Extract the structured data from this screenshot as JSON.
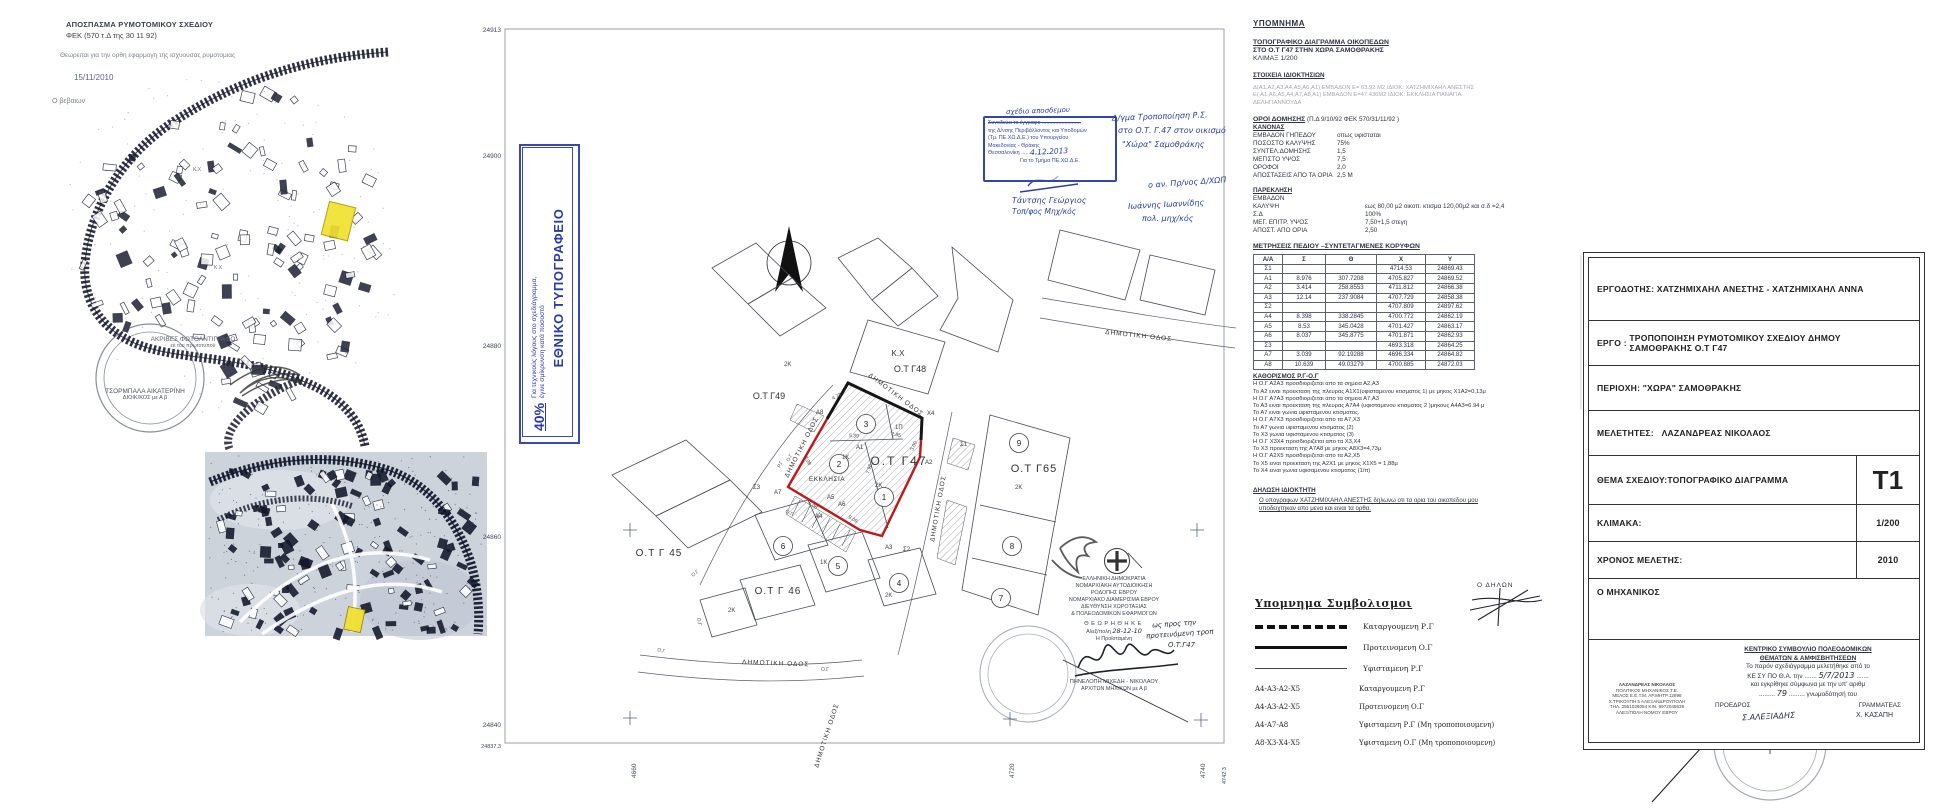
{
  "colors": {
    "highlight_yellow": "#f0e130",
    "boundary_red": "#c01818",
    "ink_blue": "#2b3f9e",
    "stamp_blue": "#3347a8"
  },
  "extract": {
    "title": "ΑΠΟΣΠΑΣΜΑ ΡΥΜΟΤΟΜΙΚΟΥ ΣΧΕΔΙΟΥ",
    "fek": "ΦΕΚ  (570 τ.Δ  της 30 11 92)",
    "certify": "Θεωρειται για την ορθη εφαρμογη της ισχυουσας ρυμοτομιας",
    "date": "15/11/2010",
    "certifier": "Ο βεβαιων",
    "copy_stamp": {
      "l1": "ΑΚΡΙΒΕΣ ΦΩΤΟΑΝΤΙΓΡΑΦΟ",
      "l2": "εκ του πρωτοτυπου",
      "name": "ΤΣΟΡΜΠΑΛΑ ΑΙΚΑΤΕΡΙΝΗ",
      "role": "ΔΙΟΙΚ/ΚΟΣ με Α β"
    }
  },
  "print_box": {
    "title": "ΕΘΝΙΚΟ ΤΥΠΟΓΡΑΦΕΙΟ",
    "note1": "Για τεχνικούς λόγους στο σχεδιάγραμμα,",
    "note2": "έγινε σμίκρυνση κατά ποσοστό",
    "percent": "40%"
  },
  "blue_stamp": {
    "l1": "Συνοδεύει το έγγραφο ..........................",
    "hand1": "σχέδιο αποσδεμου",
    "l2": "της Δ/νσης Περιβάλλοντος και Υποδομών",
    "l3": "(Τμ. ΠΕ.ΧΩ.Δ.Ε.)  του  Υπουργείου",
    "l4": "Μακεδονίας - Θράκης",
    "l5": "Θεσσαλονίκη ......................",
    "hand_date": "4.12.2013",
    "l6": "Για  το  Τμήμα  ΠΕ.ΧΩ.Δ.Ε.",
    "sig_name": "Τάντσης Γεώργιος",
    "sig_role": "Τοπ/φος Μηχ/κός"
  },
  "annotations": {
    "r1": "Δ/γμα Τροποποίηση Ρ.Σ.",
    "r2": "στο Ο.Τ. Γ.47 στον οικισμό",
    "r3": "\"Χώρα\" Σαμοθράκης",
    "r4": "ο αν. Πρ/νος Δ/ΧΩΠ",
    "r5": "Ιωάννης Ιωαννίδης",
    "r6": "πολ. μηχ/κός"
  },
  "drawing": {
    "street": "ΔΗΜΟΤΙΚΗ ΟΔΟΣ",
    "axis_left": [
      "24913",
      "24900",
      "24880",
      "24860",
      "24840",
      "24837.3"
    ],
    "axis_bottom": [
      "4660",
      "4720",
      "4740",
      "4742.3"
    ],
    "blocks": {
      "g47": "Ο.Τ Γ47",
      "g48": "Ο.Τ Γ48",
      "g49": "Ο.Τ Γ49",
      "g65": "Ο.Τ Γ65",
      "g45": "Ο.Τ Γ 45",
      "g46": "Ο.Τ Γ 46",
      "kx": "Κ.Χ"
    },
    "church": "ΕΚΚΛΗΣΙΑ",
    "plots": [
      "1",
      "2",
      "3",
      "4",
      "5",
      "6",
      "7",
      "8",
      "9"
    ],
    "vertices": {
      "s1": "Σ1",
      "s2": "Σ2",
      "s3": "Σ3",
      "a1": "Α1",
      "a2": "Α2",
      "a3": "Α3",
      "a4": "Α4",
      "a5": "Α5",
      "a6": "Α6",
      "a7": "Α7",
      "a8": "Α8",
      "x4": "Χ4"
    },
    "storeys": {
      "k2": "2Κ",
      "k1": "1Κ",
      "p1": "1Π"
    },
    "rg": "Ρ.Γ",
    "og": "Ο.Γ",
    "dims": [
      "4.73",
      "5.39",
      "2.85",
      "3.00",
      "7.98",
      "8.98",
      "9.09",
      "5.08"
    ]
  },
  "approval_stamp": {
    "l1": "ΕΛΛΗΝΙΚΗ ΔΗΜΟΚΡΑΤΙΑ",
    "l2": "ΝΟΜΑΡΧΙΑΚΗ ΑΥΤΟΔΙΟΙΚΗΣΗ",
    "l3": "ΡΟΔΟΠΗΣ ΕΒΡΟΥ",
    "l4": "ΝΟΜΑΡΧΙΑΚΟ ΔΙΑΜΕΡΙΣΜΑ ΕΒΡΟΥ",
    "l5": "ΔΙΕΥΘΥΝΣΗ ΧΩΡΟΤΑΞΙΑΣ",
    "l6": "& ΠΟΛΕΟΔΟΜΙΚΩΝ ΕΦΑΡΜΟΓΩΝ",
    "approved": "ΘΕΩΡΗΘΗΚΕ",
    "place": "Αλεξ/πολη",
    "hand_date": "28-12-10",
    "head": "Η  Προϊσταμένη",
    "hand_note1": "ως προς την",
    "hand_note2": "προτεινόμενη τροπ",
    "hand_note3": "Ο.Τ.Γ47",
    "name": "ΠΗΝΕΛΟΠΗ ΜΙΧΕΔΗ - ΝΙΚΟΛΑΟΥ",
    "role": "ΑΡΧ/ΤΩΝ ΜΗΧ/ΚΩΝ με Α β"
  },
  "legend": {
    "title": "ΥΠΟΜΝΗΜΑ",
    "sub1": "ΤΟΠΟΓΡΑΦΙΚΟ  ΔΙΑΓΡΑΜΜΑ ΟΙΚΟΠΕΔΩΝ",
    "sub2": "ΣΤΟ  Ο.Τ Γ47 ΣΤΗΝ ΧΩΡΑ ΣΑΜΟΘΡΑΚΗΣ",
    "sub3": "ΚΛΙΜΑΞ  1/200",
    "own_title": "ΣΤΟΙΧΕΙΑ ΙΔΙΟΚΤΗΣΙΩΝ",
    "own1": "Δ(Α1,Α2,Α3,Α4,Α5,Α6,Α1) ΕΜΒΑΔΟΝ  Ε= 63.92 Μ2   ΙΔΙΟΚ:  ΧΑΤΖΗΜΙΧΑΗΛ ΑΝΕΣΤΗΣ",
    "own2": "Ε( Α1,Α6,Α5,Α4,Α7,Α8,Α1) ΕΜΒΑΔΟΝ Ε=47.436Μ2  ΙΔΙΟΚ:  ΕΚΚΛΗΣΙΑ ΠΑΝΑΓΙΑ",
    "own3": "ΔΕΛΗΓΙΑΝΝΟΥΔΑ",
    "terms_title": "ΟΡΟΙ   ΔΟΜΗΣΗΣ",
    "terms_ref": "(Π.Δ 9/10/92 ΦΕΚ 570/31/11/92 )",
    "kanonas": "ΚΑΝΟΝΑΣ",
    "kanonas_rows": [
      [
        "ΕΜΒΑΔΟΝ ΓΗΠΕΔΟΥ",
        "οπως υφισταται"
      ],
      [
        "ΠΟΣΟΣΤΟ ΚΑΛΥΨΗΣ",
        "75%"
      ],
      [
        "ΣΥΝΤΕΛ.ΔΟΜΗΣΗΣ",
        "1,5"
      ],
      [
        "ΜΕΓΙΣΤΟ ΥΨΟΣ",
        "7,5"
      ],
      [
        "ΟΡΟΦΟΙ",
        "2,0"
      ],
      [
        "ΑΠΟΣΤΑΣΕΙΣ ΑΠΟ ΤΑ ΟΡΙΑ",
        "2,5 Μ"
      ]
    ],
    "parekl": "ΠΑΡΕΚΛΗΣΗ",
    "parekl_rows": [
      [
        "ΕΜΒΑΔΟΝ",
        ""
      ],
      [
        "ΚΑΛΥΨΗ",
        "εως 80,00 μ2 οικοπ. κτισμα 120,00μ2 και σ.δ =2,4"
      ],
      [
        "Σ.Δ",
        "100%"
      ],
      [
        "ΜΕΓ. ΕΠΙΤΡ. ΥΨΟΣ",
        "7,50+1,5 στεγη"
      ],
      [
        "ΑΠΟΣΤ. ΑΠΟ ΟΡΙΑ",
        "2,50"
      ]
    ],
    "table_title": "ΜΕΤΡΗΣΕΙΣ ΠΕΔΙΟΥ –ΣΥΝΤΕΤΑΓΜΕΝΕΣ ΚΟΡΥΦΩΝ",
    "table_head": [
      "Α/Α",
      "Σ",
      "Θ",
      "Χ",
      "Υ"
    ],
    "table_rows": [
      [
        "Σ1",
        "",
        "",
        "4714.53",
        "24869.43"
      ],
      [
        "Α1",
        "8.976",
        "307.7208",
        "4705.827",
        "24869.52"
      ],
      [
        "Α2",
        "3.414",
        "258.8553",
        "4711.812",
        "24866.38"
      ],
      [
        "Α3",
        "12.14",
        "237.9084",
        "4707.729",
        "24858.38"
      ],
      [
        "Σ2",
        "",
        "",
        "4707.809",
        "24897.62"
      ],
      [
        "Α4",
        "8.398",
        "338.2845",
        "4700.772",
        "24862.19"
      ],
      [
        "Α5",
        "8.53",
        "345.0428",
        "4701.427",
        "24863.17"
      ],
      [
        "Α6",
        "8.037",
        "345.8775",
        "4701.871",
        "24862.93"
      ],
      [
        "Σ3",
        "",
        "",
        "4693.318",
        "24864.25"
      ],
      [
        "Α7",
        "3.039",
        "92.19288",
        "4696.334",
        "24864.82"
      ],
      [
        "Α8",
        "10.639",
        "49.03279",
        "4700.885",
        "24872.03"
      ]
    ],
    "kath_title": "ΚΑΘΟΡΙΣΜΟΣ Ρ.Γ-Ο.Γ",
    "kath": [
      "Η Ο.Γ Α2Α3 προσδιοριζεται απο τα σημεια  Α2,Α3",
      "Το Α2 ειναι προεκταση της πλευρας Α1Χ1(υφισταμενου κτισματος 1) με μηκος Χ1Α2=0,13μ",
      "Η Ο.Γ Α7Α3 προσδιοριζεται απο τα  σημεια Α7,Α3",
      "Το Α3 ειναι προεκταση της πλευρας Α7Α4 (υφισταμενου κτισματος 2 )μηκους Α4Α3=6.94 μ",
      "Το Α7 ειναι γωνια υφισταμενου κτισματος.",
      "Η Ο.Γ Α7Χ3 προσδιοριζεται απο τα Α7,Χ3",
      "Το Α7 γωνια υφισταμενου κτισματος (2)",
      "Το Χ3 γωνια υφισταμενου κτισματος (3)",
      "Η Ο.Γ Χ3Χ4 προσδιοριζεται απο τα Χ3,Χ4",
      "Το Χ3 προεκταση της Α7Α8 με μηκος Α8Χ3=4,73μ",
      "Η Ο.Γ Α2Χ5 προσδιοριζεται απο τα Α2,Χ5",
      "Το Χ5 ειναι προεκταση της Α2Χ1 με μηκος Χ1Χ5 = 1,88μ",
      "Το Χ4 ειναι γωνια υφισαμενου κτισματος (1/π)"
    ],
    "decl_title": "ΔΗΛΩΣΗ ΙΔΙΟΚΤΗΤΗ",
    "decl1": "Ο υπογραφων  ΧΑΤΖΗΜΙΧΑΗΛ ΑΝΕΣΤΗΣ  δηλωνω οτι τα ορια του οικοπεδου μου",
    "decl2": "υποδειχτηκαν απο μενα  και ειναι τα ορθα.",
    "declarant": "Ο ΔΗΛΩΝ"
  },
  "symbols": {
    "title": "Υπομνημα  Συμβολισμοι",
    "line_rows": [
      [
        "dash",
        "Καταργουμενη  Ρ.Γ"
      ],
      [
        "thick",
        "Προτεινομενη  Ο.Γ"
      ],
      [
        "thin",
        "Υφισταμενη    Ρ.Γ"
      ]
    ],
    "code_rows": [
      [
        "Α4-Α3-Α2-Χ5",
        "Καταργουμενη Ρ.Γ"
      ],
      [
        "Α4-Α3-Α2-Χ5",
        "Προτεινομενη  Ο.Γ"
      ],
      [
        "Α4-Α7-Α8",
        "Υφισταμενη     Ρ.Γ (Μη τροποποιουμενη)"
      ],
      [
        "Α8-Χ3-Χ4-Χ5",
        "Υφισταμενη    Ο.Γ (Μη τροποποιουμενη)"
      ]
    ]
  },
  "titleblock": {
    "employer_label": "ΕΡΓΟΔΟΤΗΣ:",
    "employer": "ΧΑΤΖΗΜΙΧΑΗΛ ΑΝΕΣΤΗΣ - ΧΑΤΖΗΜΙΧΑΗΛ ΑΝΝΑ",
    "project_label": "ΕΡΓΟ :",
    "project1": "ΤΡΟΠΟΠΟΙΗΣΗ ΡΥΜΟΤΟΜΙΚΟΥ ΣΧΕΔΙΟΥ ΔΗΜΟΥ",
    "project2": "ΣΑΜΟΘΡΑΚΗΣ Ο.Τ Γ47",
    "area": "ΠΕΡΙΟΧΗ: \"ΧΩΡΑ\" ΣΑΜΟΘΡΑΚΗΣ",
    "designers_label": "ΜΕΛΕΤΗΤΕΣ:",
    "designers": "ΛΑΖΑΝΔΡΕΑΣ ΝΙΚΟΛΑΟΣ",
    "subject": "ΘΕΜΑ ΣΧΕΔΙΟΥ:ΤΟΠΟΓΡΑΦΙΚΟ ΔΙΑΓΡΑΜΜΑ",
    "sheet": "Τ1",
    "scale_label": "ΚΛΙΜΑΚΑ:",
    "scale": "1/200",
    "time_label": "ΧΡΟΝΟΣ ΜΕΛΕΤΗΣ:",
    "time": "2010",
    "engineer": "Ο ΜΗΧΑΝΙΚΟΣ",
    "stamp": [
      "ΛΑΖΑΝΔΡΕΑΣ ΝΙΚΟΛΑΟΣ",
      "ΠΟΛΙΤΙΚΟΣ ΜΗΧΑΝΙΚΟΣ Τ.Ε.",
      "ΜΕΛΟΣ Ε.Ε.Τ.Μ. ΑΡ.ΜΗΤΡ.12896",
      "Χ.ΤΡΙΚΟΥΠΗ 5 ΑΛΕΞΑΝΔΡΟΥΠΟΛΗ",
      "ΤΗΛ. 2551026054 ΚΙΝ. 6972045638",
      "ΑΛΕΞ/ΠΟΛΗ ΝΟΜΟΥ ΕΒΡΟΥ"
    ],
    "council1": "ΚΕΝΤΡΙΚΟ ΣΥΜΒΟΥΛΙΟ ΠΟΛΕΟΔΟΜΙΚΩΝ",
    "council2": "ΘΕΜΑΤΩΝ & ΑΜΦΙΣΒΗΤΗΣΕΩΝ",
    "council3": "Το παρόν σχεδιάγραμμα μελετήθηκε από το",
    "council4a": "ΚΕ ΣΥ ΠΟ Θ.Α.  την .......",
    "council4hand": "5/7/2013",
    "council4b": ".......",
    "council5": "και εγκρίθηκε σύμφωνα με την υπ' αριθμ",
    "council6a": ".........",
    "council6hand": "79",
    "council6b": "......... γνωμοδότησή του",
    "council7a": "ΠΡΟΕΔΡΟΣ",
    "council7b": "ΓΡΑΜΜΑΤΕΑΣ",
    "sig1": "Σ.ΑΛΕΞΙΑΔΗΣ",
    "sig2": "Χ. ΚΑΣΑΠΗ"
  }
}
